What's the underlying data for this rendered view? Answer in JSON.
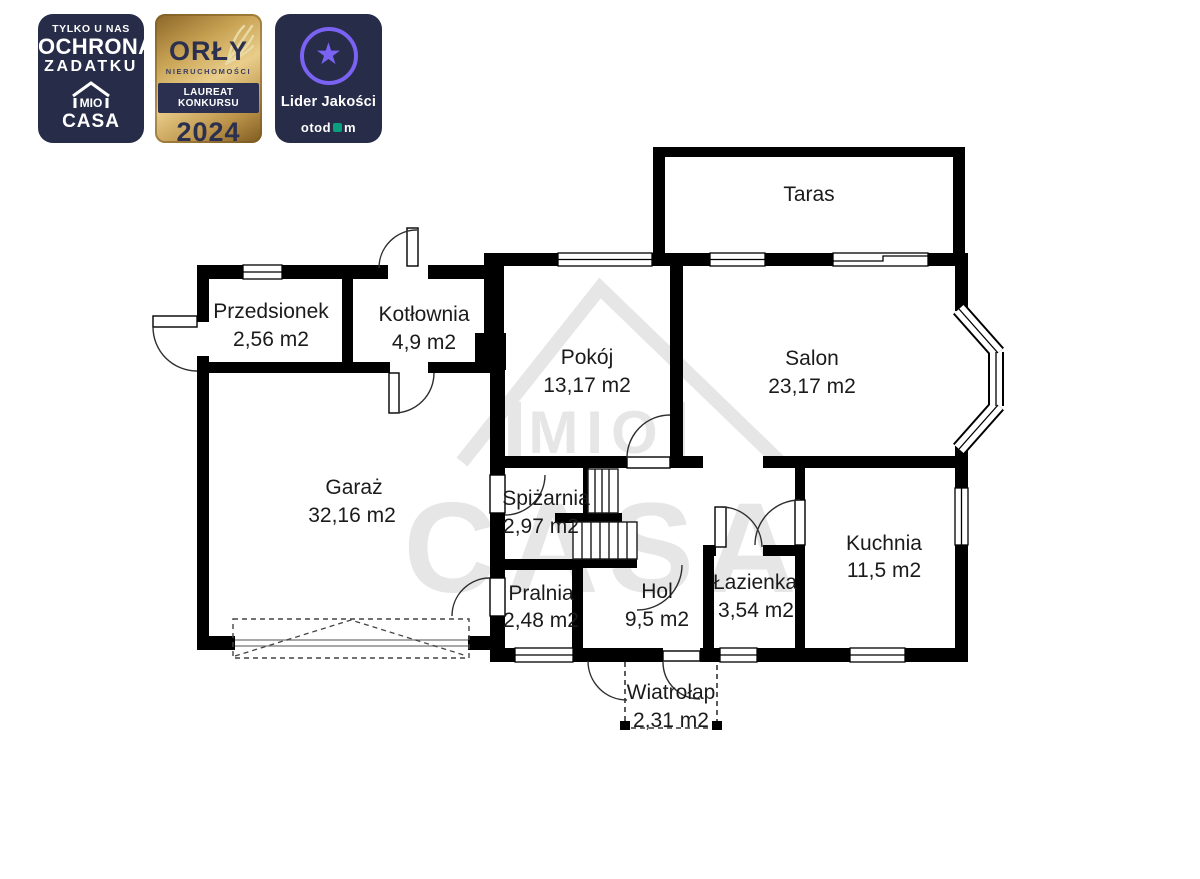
{
  "badges": {
    "ochrona": {
      "line1": "TYLKO U NAS",
      "line2": "OCHRONA",
      "line3": "ZADATKU",
      "logo_top": "MIO",
      "logo_bottom": "CASA"
    },
    "orly": {
      "title": "ORŁY",
      "subtitle": "NIERUCHOMOŚCI",
      "band": "LAUREAT KONKURSU",
      "year": "2024"
    },
    "lider": {
      "title": "Lider Jakości",
      "brand_prefix": "otod",
      "brand_suffix": "m"
    }
  },
  "watermark": {
    "mio": "MIO",
    "casa": "CASA"
  },
  "rooms": [
    {
      "name": "Taras",
      "area": ""
    },
    {
      "name": "Przedsionek",
      "area": "2,56 m2"
    },
    {
      "name": "Kotłownia",
      "area": "4,9 m2"
    },
    {
      "name": "Pokój",
      "area": "13,17 m2"
    },
    {
      "name": "Salon",
      "area": "23,17 m2"
    },
    {
      "name": "Garaż",
      "area": "32,16 m2"
    },
    {
      "name": "Spiżarnia",
      "area": "2,97 m2"
    },
    {
      "name": "Kuchnia",
      "area": "11,5 m2"
    },
    {
      "name": "Pralnia",
      "area": "2,48 m2"
    },
    {
      "name": "Hol",
      "area": "9,5 m2"
    },
    {
      "name": "Łazienka",
      "area": "3,54 m2"
    },
    {
      "name": "Wiatrołap",
      "area": "2,31 m2"
    }
  ],
  "colors": {
    "wall": "#000000",
    "navy_badge": "#272c49",
    "gold": "#c7a152",
    "purple": "#7a62f2",
    "otodom_green": "#0a9f7d",
    "watermark_gray": "#e6e6e6"
  }
}
